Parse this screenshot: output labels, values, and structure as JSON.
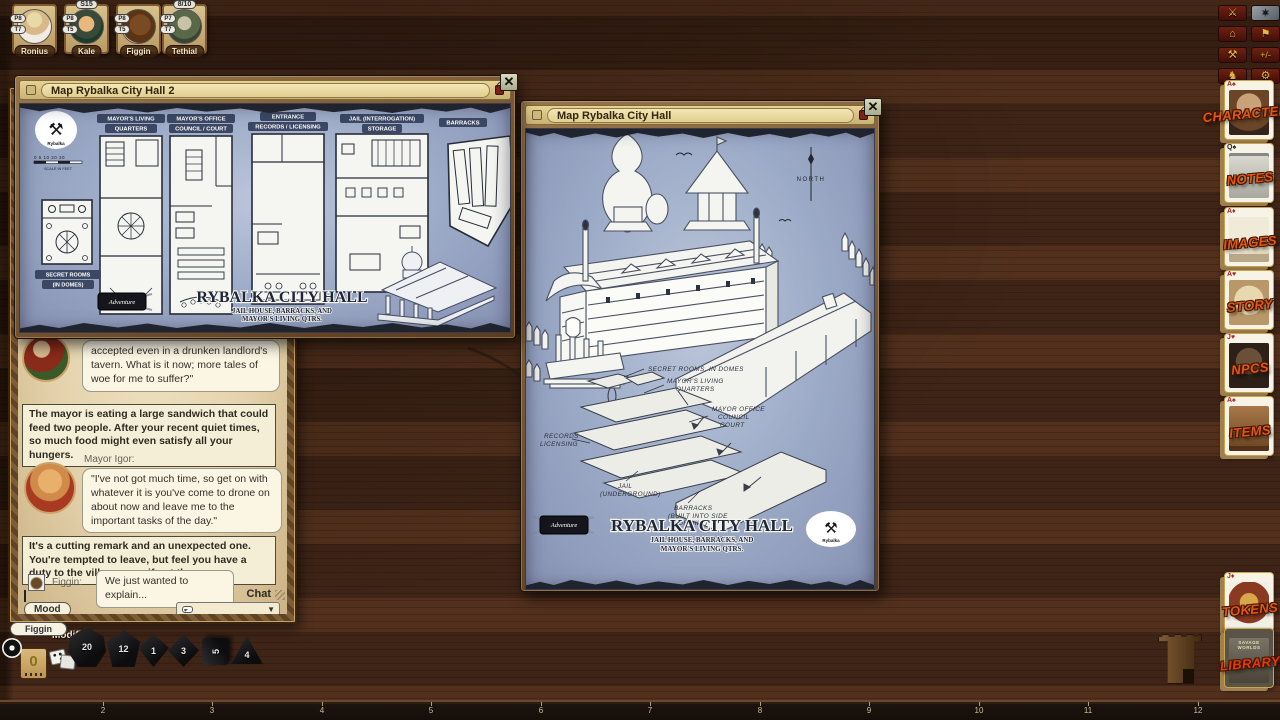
{
  "party": {
    "members": [
      {
        "name": "Ronius",
        "top_badge": "",
        "badges": [
          "P8",
          "T7"
        ]
      },
      {
        "name": "Kale",
        "top_badge": "S15",
        "badges": [
          "P8",
          "T5"
        ]
      },
      {
        "name": "Figgin",
        "top_badge": "",
        "badges": [
          "P8",
          "T5"
        ]
      },
      {
        "name": "Tethial",
        "top_badge": "8/10",
        "badges": [
          "P7",
          "T7"
        ]
      }
    ]
  },
  "toolbar": {
    "buttons": [
      {
        "name": "encounter",
        "glyph": "⚔"
      },
      {
        "name": "weapon-art",
        "glyph": "✶"
      },
      {
        "name": "shelter",
        "glyph": "⌂"
      },
      {
        "name": "flag",
        "glyph": "⚑"
      },
      {
        "name": "forge",
        "glyph": "⚒"
      },
      {
        "name": "modifiers",
        "glyph": "+/-"
      },
      {
        "name": "figure",
        "glyph": "♞"
      },
      {
        "name": "options",
        "glyph": "⚙"
      }
    ]
  },
  "sidebar": {
    "cards": [
      {
        "label": "CHARACTERS",
        "pip": "A♠"
      },
      {
        "label": "NOTES",
        "pip": "Q♠"
      },
      {
        "label": "IMAGES",
        "pip": "A♦"
      },
      {
        "label": "STORY",
        "pip": "A♥"
      },
      {
        "label": "NPCS",
        "pip": "J♥"
      },
      {
        "label": "ITEMS",
        "pip": "A♠"
      },
      {
        "label": "TOKENS",
        "pip": "J♦"
      },
      {
        "label": "LIBRARY",
        "pip": ""
      }
    ],
    "library_cover": "SAVAGE WORLDS"
  },
  "map1": {
    "title": "Map Rybalka City Hall 2",
    "logo_glyph": "⚒",
    "logo_name": "Rybalka",
    "scale_ticks": "0  5  10      20      30",
    "scale_caption": "SCALE IN FEET",
    "secret_label_1": "SECRET ROOMS",
    "secret_label_2": "(IN DOMES)",
    "plans": [
      {
        "l1": "MAYOR'S LIVING",
        "l2": "QUARTERS"
      },
      {
        "l1": "MAYOR'S OFFICE",
        "l2": "COUNCIL / COURT"
      },
      {
        "l1": "ENTRANCE",
        "l2": "RECORDS / LICENSING"
      },
      {
        "l1": "JAIL (INTERROGATION)",
        "l2": "STORAGE"
      },
      {
        "l1": "BARRACKS",
        "l2": ""
      }
    ],
    "footer": {
      "brand": "Adventure",
      "title": "RYBALKA CITY HALL",
      "sub1": "JAIL HOUSE, BARRACKS, AND",
      "sub2": "MAYOR'S LIVING QTRS."
    }
  },
  "map2": {
    "title": "Map Rybalka City Hall",
    "north": "NORTH",
    "annotations": {
      "secret": "SECRET ROOMS, IN DOMES",
      "living1": "MAYOR'S LIVING",
      "living2": "QUARTERS",
      "office1": "MAYOR OFFICE",
      "office2": "COUNCIL",
      "office3": "COURT",
      "records1": "RECORDS -",
      "records2": "LICENSING",
      "jail1": "JAIL",
      "jail2": "(UNDERGROUND)",
      "barracks1": "BARRACKS",
      "barracks2": "(BUILT INTO SIDE",
      "barracks3": "OF HILL)"
    },
    "footer": {
      "brand": "Adventure",
      "title": "RYBALKA CITY HALL",
      "sub1": "JAIL HOUSE, BARRACKS, AND",
      "sub2": "MAYOR'S LIVING QTRS.",
      "logo_glyph": "⚒",
      "logo_name": "Rybalka"
    }
  },
  "chat": {
    "messages": {
      "m1": "accepted even in a drunken landlord's tavern. What is it now; more tales of woe for me to suffer?\"",
      "n1": "The mayor is eating a large sandwich that could feed two people. After your recent quiet times, so much food might even satisfy all your hungers.",
      "speaker2": "Mayor Igor:",
      "m2": "\"I've not got much time, so get on with whatever it is you've come to drone on about now and leave me to the important tasks of the day.\"",
      "n2": "It's a cutting remark and an unexpected one. You're tempted to leave, but feel you have a duty to the village even if not the mayor.",
      "speaker3": "Figgin:",
      "m3": "We just wanted to explain..."
    },
    "chat_label": "Chat",
    "mood_label": "Mood"
  },
  "tray": {
    "tab": "Figgin",
    "modifier_label": "Modifier",
    "modifier_value": "0",
    "dice": [
      {
        "name": "d20",
        "value": "20"
      },
      {
        "name": "d12",
        "value": "12"
      },
      {
        "name": "d10",
        "value": "1"
      },
      {
        "name": "d8",
        "value": "3"
      },
      {
        "name": "d6",
        "value": "5"
      },
      {
        "name": "d4",
        "value": "4"
      }
    ]
  },
  "ruler": {
    "numbers": [
      "2",
      "3",
      "4",
      "5",
      "6",
      "7",
      "8",
      "9",
      "10",
      "11",
      "12"
    ]
  }
}
